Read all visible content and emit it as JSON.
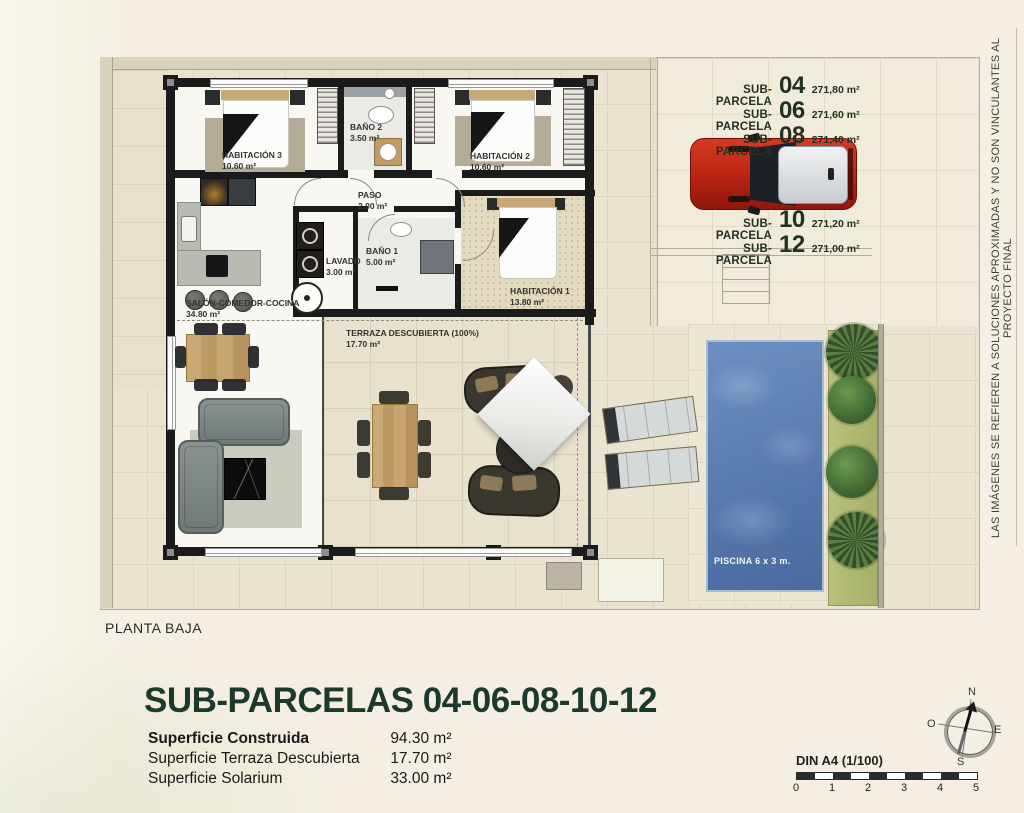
{
  "page": {
    "floor_label": "PLANTA BAJA"
  },
  "plan": {
    "rooms": {
      "hab3": {
        "name": "HABITACIÓN 3",
        "area": "10.60 m²"
      },
      "bano2": {
        "name": "BAÑO 2",
        "area": "3.50 m²"
      },
      "hab2": {
        "name": "HABITACIÓN 2",
        "area": "10.60 m²"
      },
      "paso": {
        "name": "PASO",
        "area": "2.00 m²"
      },
      "lavado": {
        "name": "LAVADO",
        "area": "3.00 m²"
      },
      "bano1": {
        "name": "BAÑO 1",
        "area": "5.00 m²"
      },
      "hab1": {
        "name": "HABITACIÓN 1",
        "area": "13.80 m²"
      },
      "salon": {
        "name": "SALÓN-COMEDOR-COCINA",
        "area": "34.80 m²"
      },
      "terraza": {
        "name": "TERRAZA DESCUBIERTA (100%)",
        "area": "17.70 m²"
      }
    },
    "pool_label": "PISCINA 6 x 3 m.",
    "parcels_top": [
      {
        "label": "SUB-PARCELA",
        "number": "04",
        "area": "271,80 m²"
      },
      {
        "label": "SUB-PARCELA",
        "number": "06",
        "area": "271,60 m²"
      },
      {
        "label": "SUB-PARCELA",
        "number": "08",
        "area": "271,40 m²"
      }
    ],
    "parcels_bottom": [
      {
        "label": "SUB-PARCELA",
        "number": "10",
        "area": "271,20 m²"
      },
      {
        "label": "SUB-PARCELA",
        "number": "12",
        "area": "271,00 m²"
      }
    ],
    "disclaimer": "LAS IMÁGENES SE REFIEREN A SOLUCIONES APROXIMADAS Y NO SON VINCULANTES AL PROYECTO FINAL"
  },
  "footer": {
    "title": "SUB-PARCELAS 04-06-08-10-12",
    "areas": [
      {
        "label": "Superficie Construida",
        "value": "94.30 m²"
      },
      {
        "label": "Superficie Terraza Descubierta",
        "value": "17.70 m²"
      },
      {
        "label": "Superficie Solarium",
        "value": "33.00 m²"
      }
    ],
    "scale_label": "DIN A4 (1/100)",
    "scale_ticks": [
      "0",
      "1",
      "2",
      "3",
      "4",
      "5"
    ],
    "compass": {
      "n": "N",
      "s": "S",
      "e": "E",
      "w": "O"
    }
  },
  "colors": {
    "title_green": "#1c3a2b",
    "pool_blue": "#49699f",
    "car_red": "#c02715",
    "background": "#f4efe2"
  }
}
